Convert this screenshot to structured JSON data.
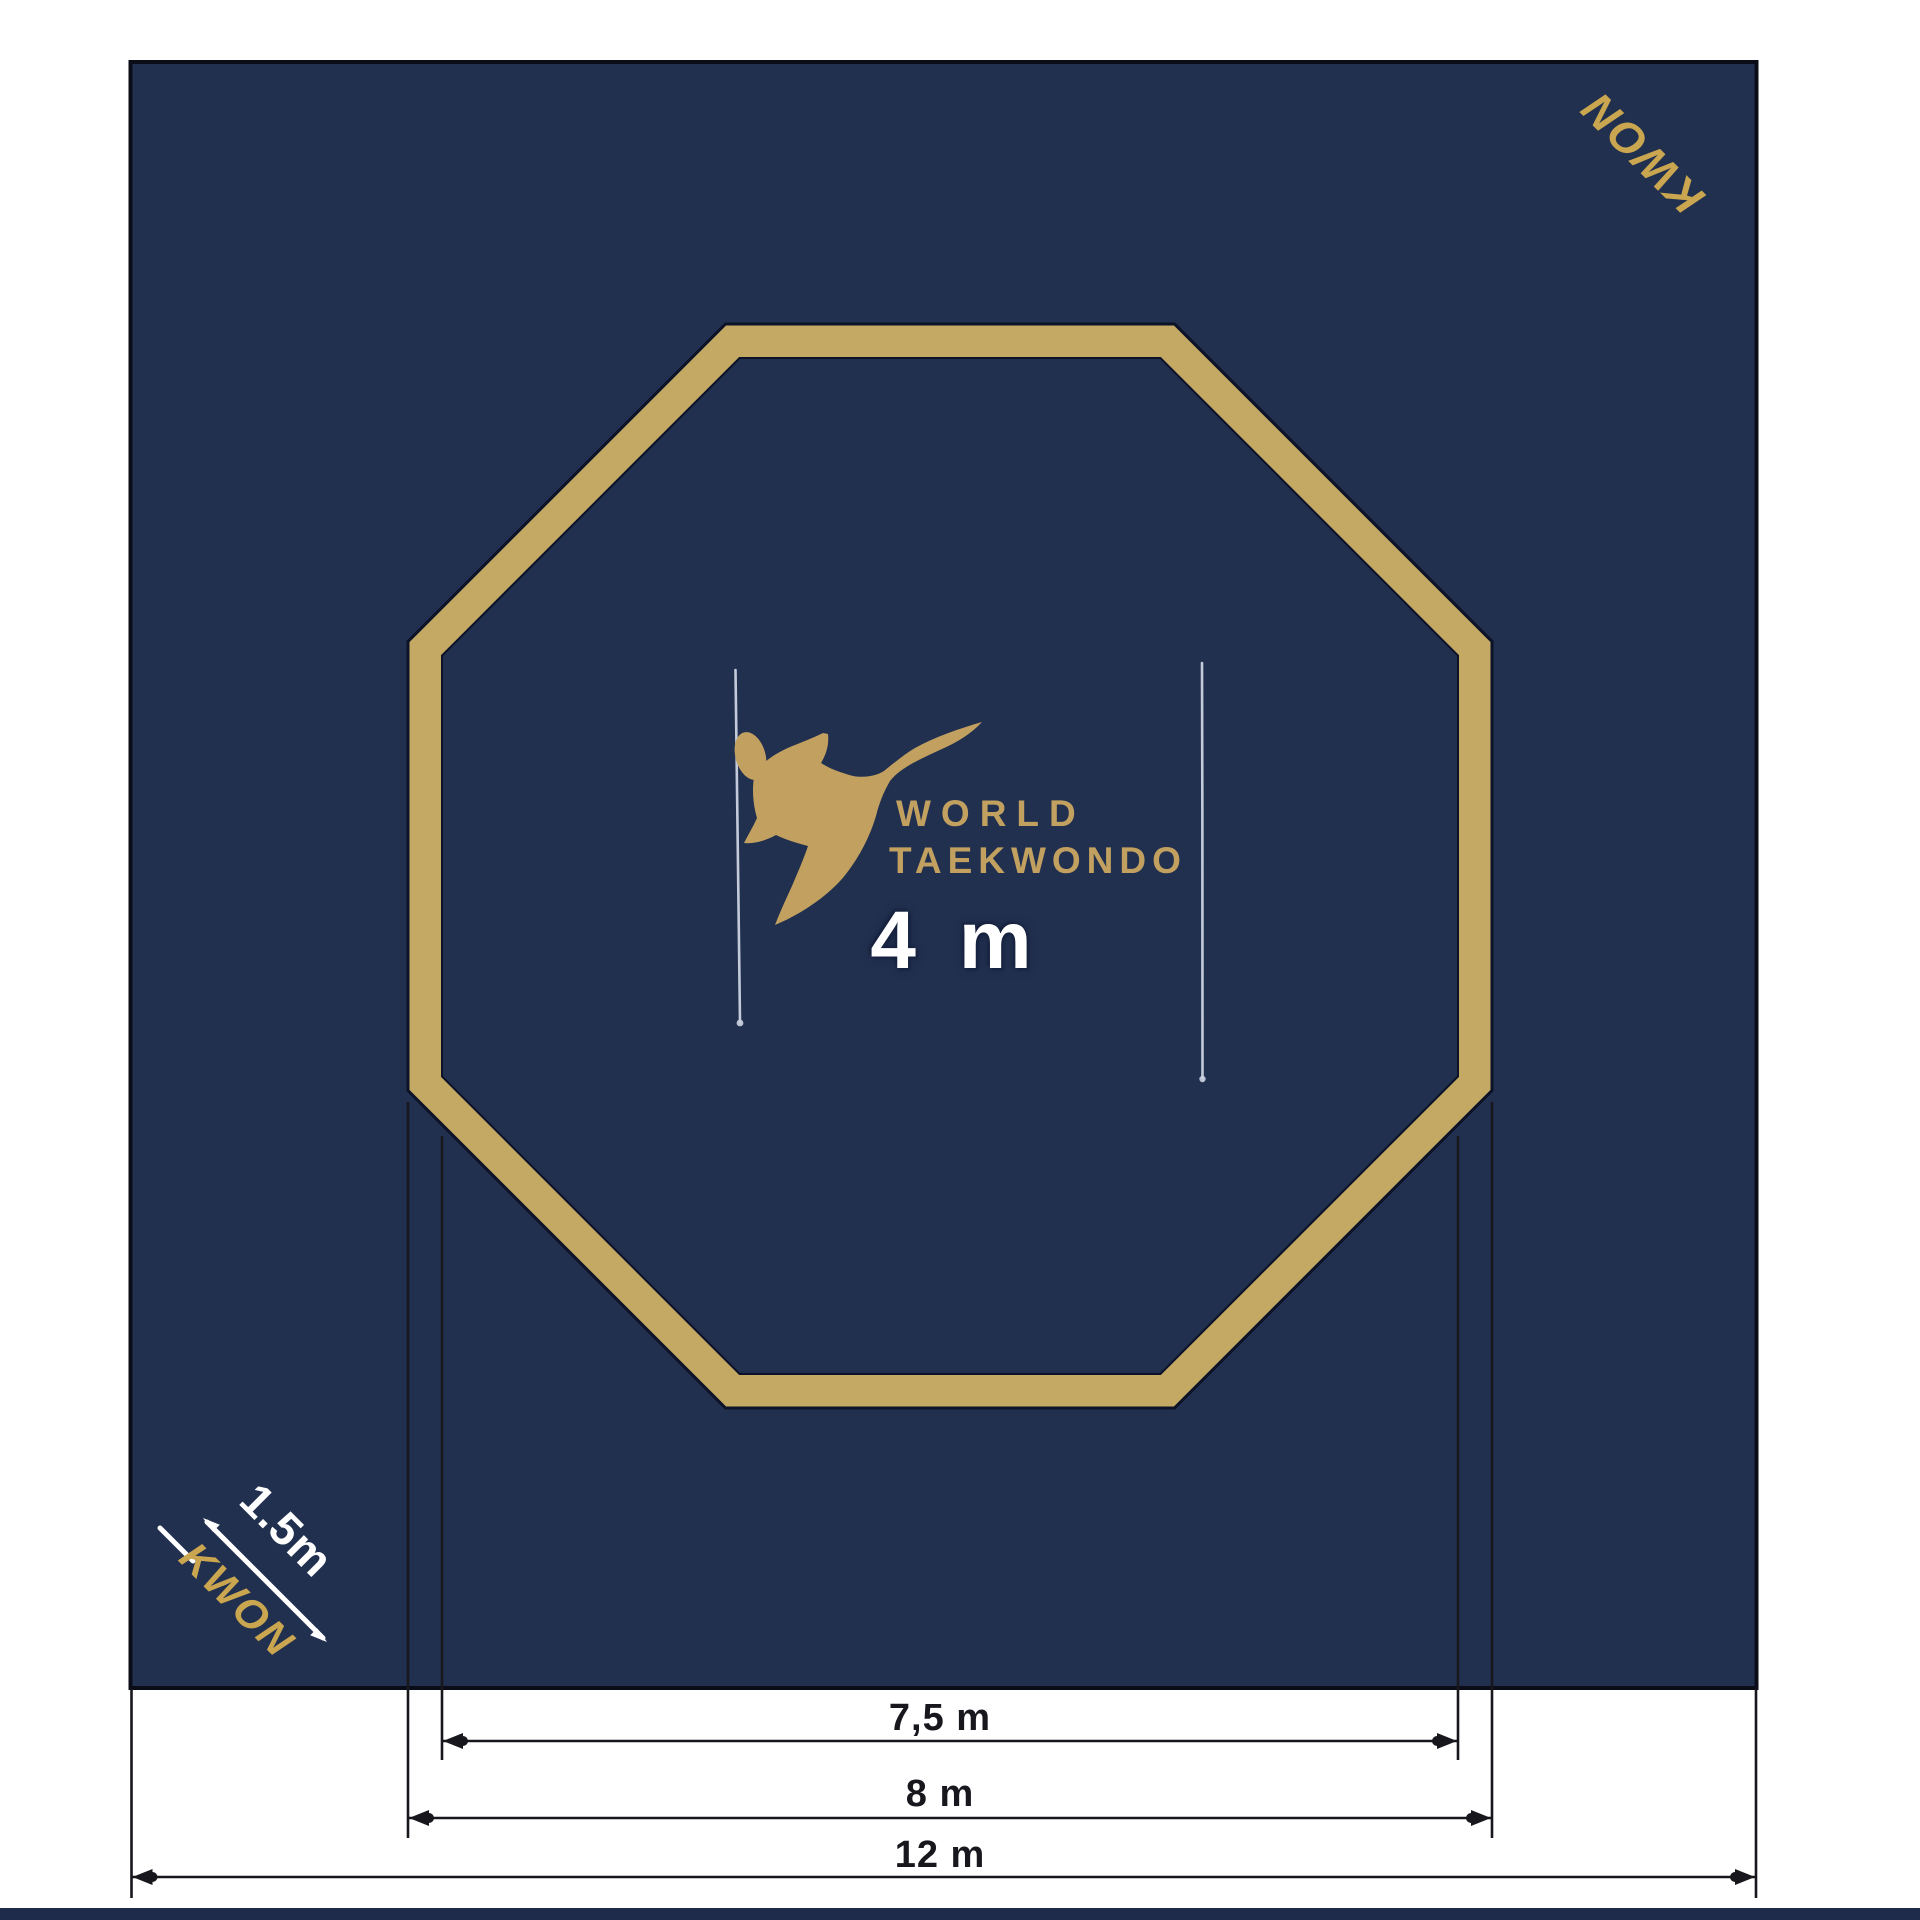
{
  "diagram": {
    "title_implicit": "World Taekwondo octagonal competition area",
    "colors": {
      "mat_navy": "#22304f",
      "octagon_gold": "#c4a965",
      "logo_gold": "#c2a160",
      "brand_gold": "#c9a64f",
      "dimension_line_black": "#17171d",
      "measure_line_white": "#ccd4e2",
      "footer_strip_navy": "#1f2b4a",
      "page_background": "#ffffff"
    },
    "mat": {
      "brand_top_right": "KWON",
      "brand_bottom_left": "KWON",
      "corner_measure_label": "1.5m"
    },
    "logo": {
      "wordmark_line1": "WORLD",
      "wordmark_line2": "TAEKWONDO",
      "symbol": "kicking-figure"
    },
    "center_measure": {
      "label": "4 m"
    },
    "dimensions": {
      "inner_octagon_width": {
        "label": "7,5 m"
      },
      "outer_octagon_width": {
        "label": "8 m"
      },
      "mat_width": {
        "label": "12 m"
      }
    }
  }
}
